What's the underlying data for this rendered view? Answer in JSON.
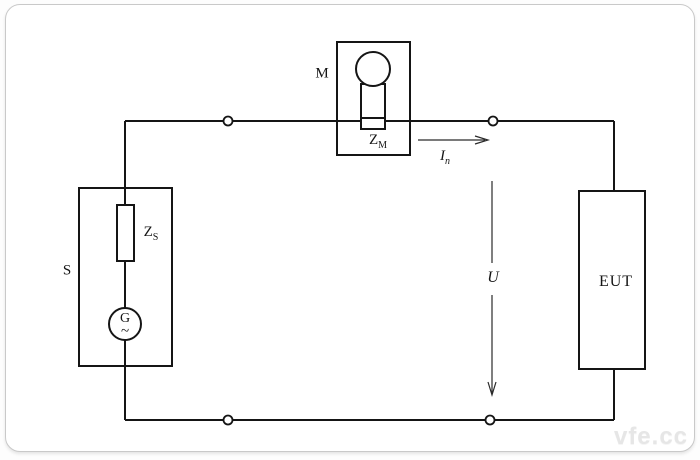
{
  "diagram": {
    "title_semantic": "EUT test circuit with source, measuring device and equipment under test",
    "labels": {
      "source": "S",
      "source_impedance": {
        "base": "Z",
        "sub": "S"
      },
      "generator": "G",
      "generator_waveform": "~",
      "measuring_device": "M",
      "measuring_impedance": {
        "base": "Z",
        "sub": "M"
      },
      "rated_current": {
        "base": "I",
        "sub": "n"
      },
      "voltage": "U",
      "eut": "EUT"
    },
    "watermark": "vfe.cc",
    "colors": {
      "line": "#151515",
      "card_border": "#c9c9c9",
      "background": "#ffffff",
      "watermark": "#e6e6e6"
    }
  }
}
